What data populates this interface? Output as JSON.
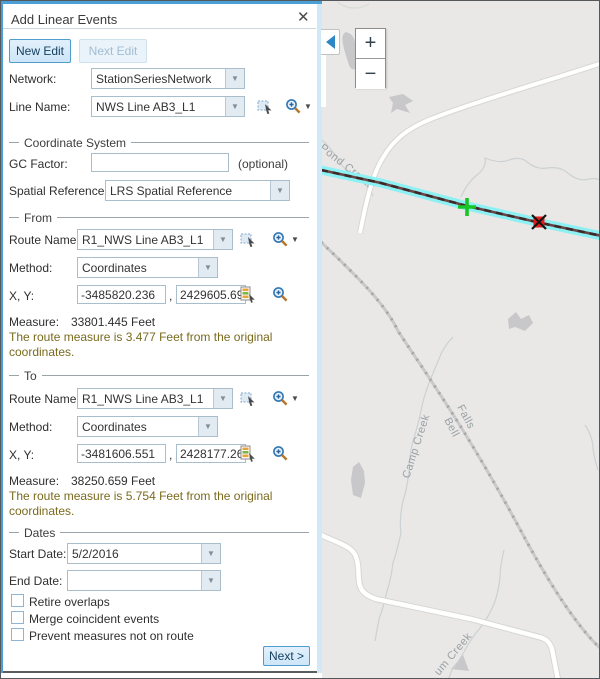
{
  "window": {
    "title": "Add Linear Events",
    "close_glyph": "✕"
  },
  "toolbar": {
    "new_edit": "New Edit",
    "next_edit": "Next Edit"
  },
  "network": {
    "label": "Network:",
    "value": "StationSeriesNetwork"
  },
  "line_name": {
    "label": "Line Name:",
    "value": "NWS Line AB3_L1"
  },
  "coordinate_system": {
    "section_title": "Coordinate System",
    "gc_factor_label": "GC Factor:",
    "gc_factor_value": "",
    "optional_hint": "(optional)",
    "spatial_reference_label": "Spatial Reference:",
    "spatial_reference_value": "LRS Spatial Reference"
  },
  "from": {
    "section_title": "From",
    "route_name_label": "Route Name:",
    "route_name_value": "R1_NWS Line AB3_L1",
    "method_label": "Method:",
    "method_value": "Coordinates",
    "xy_label": "X, Y:",
    "x_value": "-3485820.236",
    "comma": ",",
    "y_value": "2429605.69",
    "measure_label": "Measure:",
    "measure_value": "33801.445 Feet",
    "note": "The route measure is 3.477 Feet from the original coordinates."
  },
  "to": {
    "section_title": "To",
    "route_name_label": "Route Name:",
    "route_name_value": "R1_NWS Line AB3_L1",
    "method_label": "Method:",
    "method_value": "Coordinates",
    "xy_label": "X, Y:",
    "x_value": "-3481606.551",
    "comma": ",",
    "y_value": "2428177.26",
    "measure_label": "Measure:",
    "measure_value": "38250.659 Feet",
    "note": "The route measure is 5.754 Feet from the original coordinates."
  },
  "dates": {
    "section_title": "Dates",
    "start_label": "Start Date:",
    "start_value": "5/2/2016",
    "end_label": "End Date:",
    "end_value": ""
  },
  "options": [
    {
      "label": "Retire overlaps",
      "checked": false
    },
    {
      "label": "Merge coincident events",
      "checked": false
    },
    {
      "label": "Prevent measures not on route",
      "checked": false
    }
  ],
  "footer": {
    "next_label": "Next >"
  },
  "map": {
    "zoom_in_glyph": "+",
    "zoom_out_glyph": "−",
    "labels": {
      "pond_creek": "Pond Creek",
      "falls": "Falls",
      "bell": "Bell",
      "camp_creek": "Camp Creek",
      "um_creek": "um Creek"
    },
    "colors": {
      "map_background": "#e9e8e6",
      "route_highlight": "#8df0f2",
      "route_core": "#5a3838",
      "start_marker_green": "#17c527",
      "end_marker_red": "#e81b1b",
      "road": "#ffffff",
      "railroad": "#b9b9b9",
      "label_gray": "#99a1a6"
    }
  }
}
